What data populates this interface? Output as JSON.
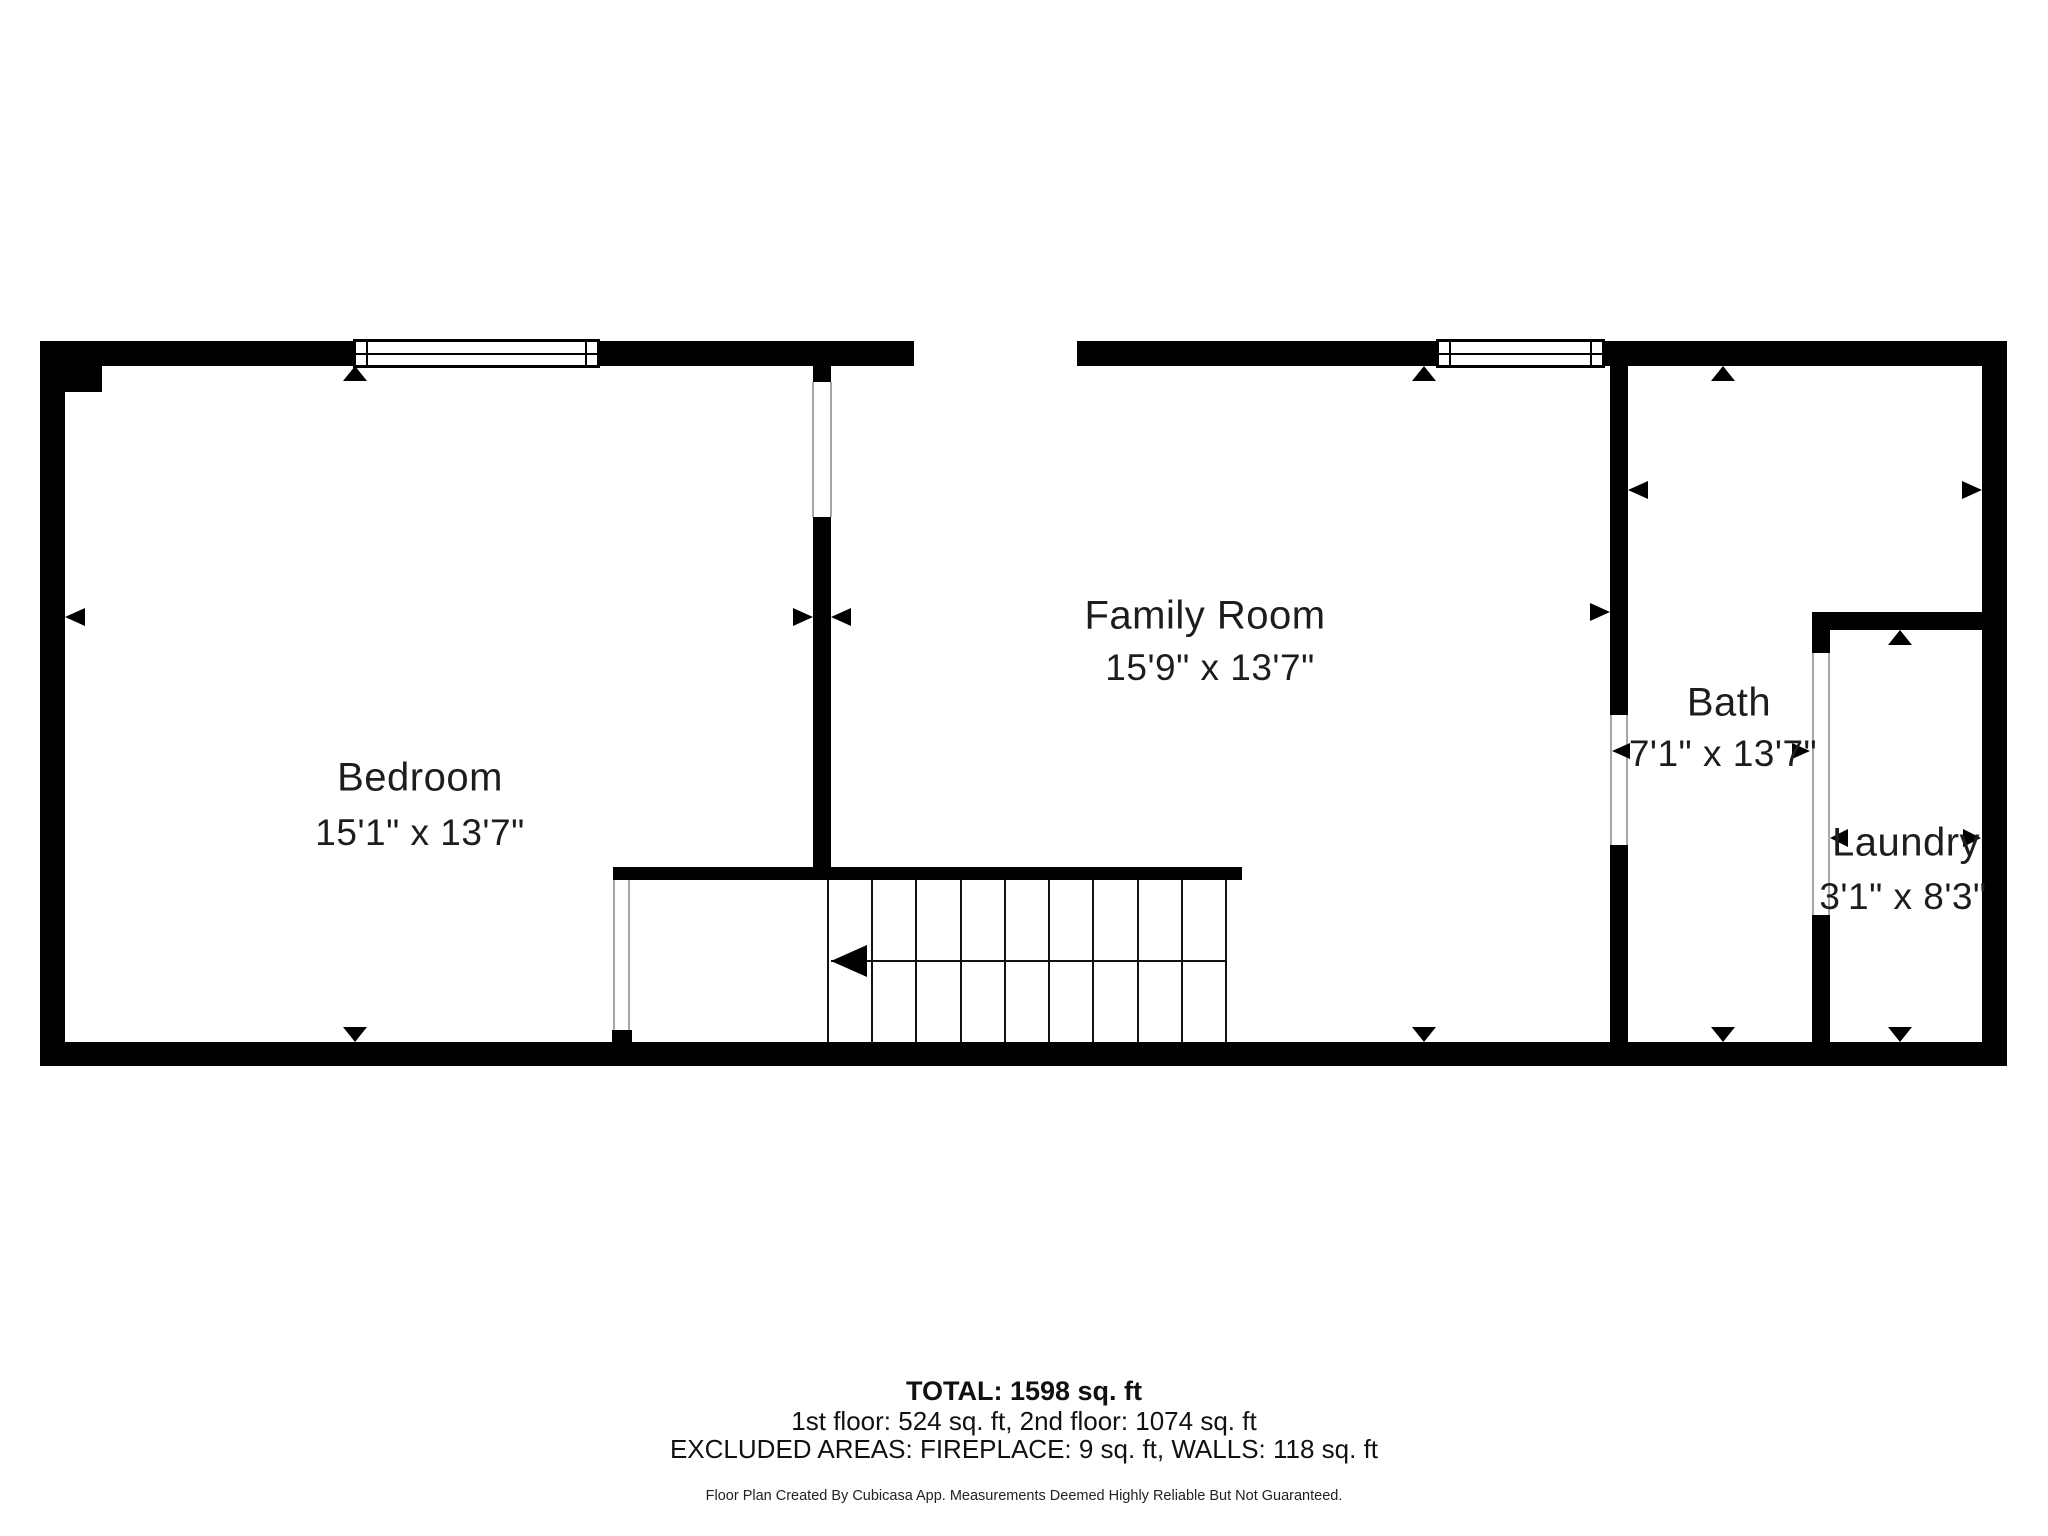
{
  "rooms": [
    {
      "name": "Bedroom",
      "dims": "15'1\" x 13'7\"",
      "name_x": 420,
      "name_y": 778,
      "dims_x": 420,
      "dims_y": 833
    },
    {
      "name": "Family Room",
      "dims": "15'9\" x 13'7\"",
      "name_x": 1205,
      "name_y": 616,
      "dims_x": 1210,
      "dims_y": 668
    },
    {
      "name": "Bath",
      "dims": "7'1\" x 13'7\"",
      "name_x": 1729,
      "name_y": 703,
      "dims_x": 1723,
      "dims_y": 754
    },
    {
      "name": "Laundry",
      "dims": "3'1\" x 8'3\"",
      "name_x": 1906,
      "name_y": 843,
      "dims_x": 1903,
      "dims_y": 897
    }
  ],
  "footer": {
    "total": "TOTAL: 1598 sq. ft",
    "floors": "1st floor: 524 sq. ft, 2nd floor: 1074 sq. ft",
    "excluded": "EXCLUDED AREAS: FIREPLACE: 9 sq. ft, WALLS: 118 sq. ft",
    "disclaimer": "Floor Plan Created By Cubicasa App. Measurements Deemed Highly Reliable But Not Guaranteed.",
    "total_y": 1393,
    "floors_y": 1422,
    "excluded_y": 1450,
    "disclaimer_y": 1497
  },
  "colors": {
    "wall": "#000000",
    "background": "#ffffff",
    "text": "#1d1d1f",
    "jamb": "#a6a6a6"
  },
  "plan": {
    "walls": [
      {
        "x": 40,
        "y": 341,
        "w": 874,
        "h": 25,
        "part": "top-wall-left-segment"
      },
      {
        "x": 1077,
        "y": 341,
        "w": 930,
        "h": 25,
        "part": "top-wall-right-segment"
      },
      {
        "x": 40,
        "y": 1042,
        "w": 1967,
        "h": 24,
        "part": "bottom-wall"
      },
      {
        "x": 40,
        "y": 341,
        "w": 25,
        "h": 725,
        "part": "left-wall"
      },
      {
        "x": 1982,
        "y": 341,
        "w": 25,
        "h": 725,
        "part": "right-wall"
      },
      {
        "x": 40,
        "y": 341,
        "w": 62,
        "h": 51,
        "part": "top-left-corner-block"
      },
      {
        "x": 813,
        "y": 366,
        "w": 18,
        "h": 16,
        "part": "bedroom-family-wall-stub"
      },
      {
        "x": 813,
        "y": 517,
        "w": 18,
        "h": 363,
        "part": "bedroom-family-wall"
      },
      {
        "x": 613,
        "y": 867,
        "w": 629,
        "h": 13,
        "part": "stairwell-wall"
      },
      {
        "x": 612,
        "y": 1030,
        "w": 20,
        "h": 12,
        "part": "bedroom-door-stub"
      },
      {
        "x": 1610,
        "y": 366,
        "w": 18,
        "h": 349,
        "part": "family-bath-wall-upper"
      },
      {
        "x": 1610,
        "y": 845,
        "w": 18,
        "h": 197,
        "part": "family-bath-wall-lower"
      },
      {
        "x": 1812,
        "y": 612,
        "w": 170,
        "h": 18,
        "part": "laundry-top-wall"
      },
      {
        "x": 1812,
        "y": 630,
        "w": 18,
        "h": 23,
        "part": "laundry-wall-stub"
      },
      {
        "x": 1812,
        "y": 915,
        "w": 18,
        "h": 127,
        "part": "laundry-wall-lower"
      }
    ],
    "windows": [
      {
        "x": 353,
        "y": 339,
        "w": 247,
        "h": 29
      },
      {
        "x": 1436,
        "y": 339,
        "w": 169,
        "h": 29
      }
    ],
    "door_jambs": [
      {
        "x": 812,
        "y": 382,
        "w": 2,
        "h": 135
      },
      {
        "x": 830,
        "y": 382,
        "w": 2,
        "h": 135
      },
      {
        "x": 1610,
        "y": 715,
        "w": 2,
        "h": 130
      },
      {
        "x": 1626,
        "y": 715,
        "w": 2,
        "h": 130
      },
      {
        "x": 1812,
        "y": 653,
        "w": 2,
        "h": 262
      },
      {
        "x": 1828,
        "y": 653,
        "w": 2,
        "h": 262
      },
      {
        "x": 613,
        "y": 880,
        "w": 2,
        "h": 150
      },
      {
        "x": 628,
        "y": 880,
        "w": 2,
        "h": 150
      }
    ],
    "stairs": {
      "left": 828,
      "right": 1226,
      "top": 880,
      "bottom": 1042,
      "tread_lines": 10,
      "line_w": 2,
      "run_y": 960,
      "run_x1": 831,
      "run_x2": 1226,
      "arrow": {
        "tip_x": 831,
        "tip_y": 961,
        "w": 36,
        "h": 32,
        "dir": "left"
      }
    },
    "dimension_arrows": [
      {
        "tip_x": 65,
        "tip_y": 617,
        "dir": "left",
        "w": 20,
        "h": 18
      },
      {
        "tip_x": 813,
        "tip_y": 617,
        "dir": "right",
        "w": 20,
        "h": 18
      },
      {
        "tip_x": 831,
        "tip_y": 617,
        "dir": "left",
        "w": 20,
        "h": 18
      },
      {
        "tip_x": 1610,
        "tip_y": 612,
        "dir": "right",
        "w": 20,
        "h": 18
      },
      {
        "tip_x": 1628,
        "tip_y": 490,
        "dir": "left",
        "w": 20,
        "h": 18
      },
      {
        "tip_x": 1982,
        "tip_y": 490,
        "dir": "right",
        "w": 20,
        "h": 18
      },
      {
        "tip_x": 1612,
        "tip_y": 751,
        "dir": "left",
        "w": 18,
        "h": 16
      },
      {
        "tip_x": 1810,
        "tip_y": 751,
        "dir": "right",
        "w": 18,
        "h": 16
      },
      {
        "tip_x": 1830,
        "tip_y": 838,
        "dir": "left",
        "w": 18,
        "h": 18
      },
      {
        "tip_x": 1981,
        "tip_y": 838,
        "dir": "right",
        "w": 18,
        "h": 18
      },
      {
        "tip_x": 355,
        "tip_y": 366,
        "dir": "up",
        "w": 24,
        "h": 15
      },
      {
        "tip_x": 1424,
        "tip_y": 366,
        "dir": "up",
        "w": 24,
        "h": 15
      },
      {
        "tip_x": 1723,
        "tip_y": 366,
        "dir": "up",
        "w": 24,
        "h": 15
      },
      {
        "tip_x": 1900,
        "tip_y": 630,
        "dir": "up",
        "w": 24,
        "h": 15
      },
      {
        "tip_x": 355,
        "tip_y": 1042,
        "dir": "down",
        "w": 24,
        "h": 15
      },
      {
        "tip_x": 1424,
        "tip_y": 1042,
        "dir": "down",
        "w": 24,
        "h": 15
      },
      {
        "tip_x": 1723,
        "tip_y": 1042,
        "dir": "down",
        "w": 24,
        "h": 15
      },
      {
        "tip_x": 1900,
        "tip_y": 1042,
        "dir": "down",
        "w": 24,
        "h": 15
      }
    ]
  }
}
